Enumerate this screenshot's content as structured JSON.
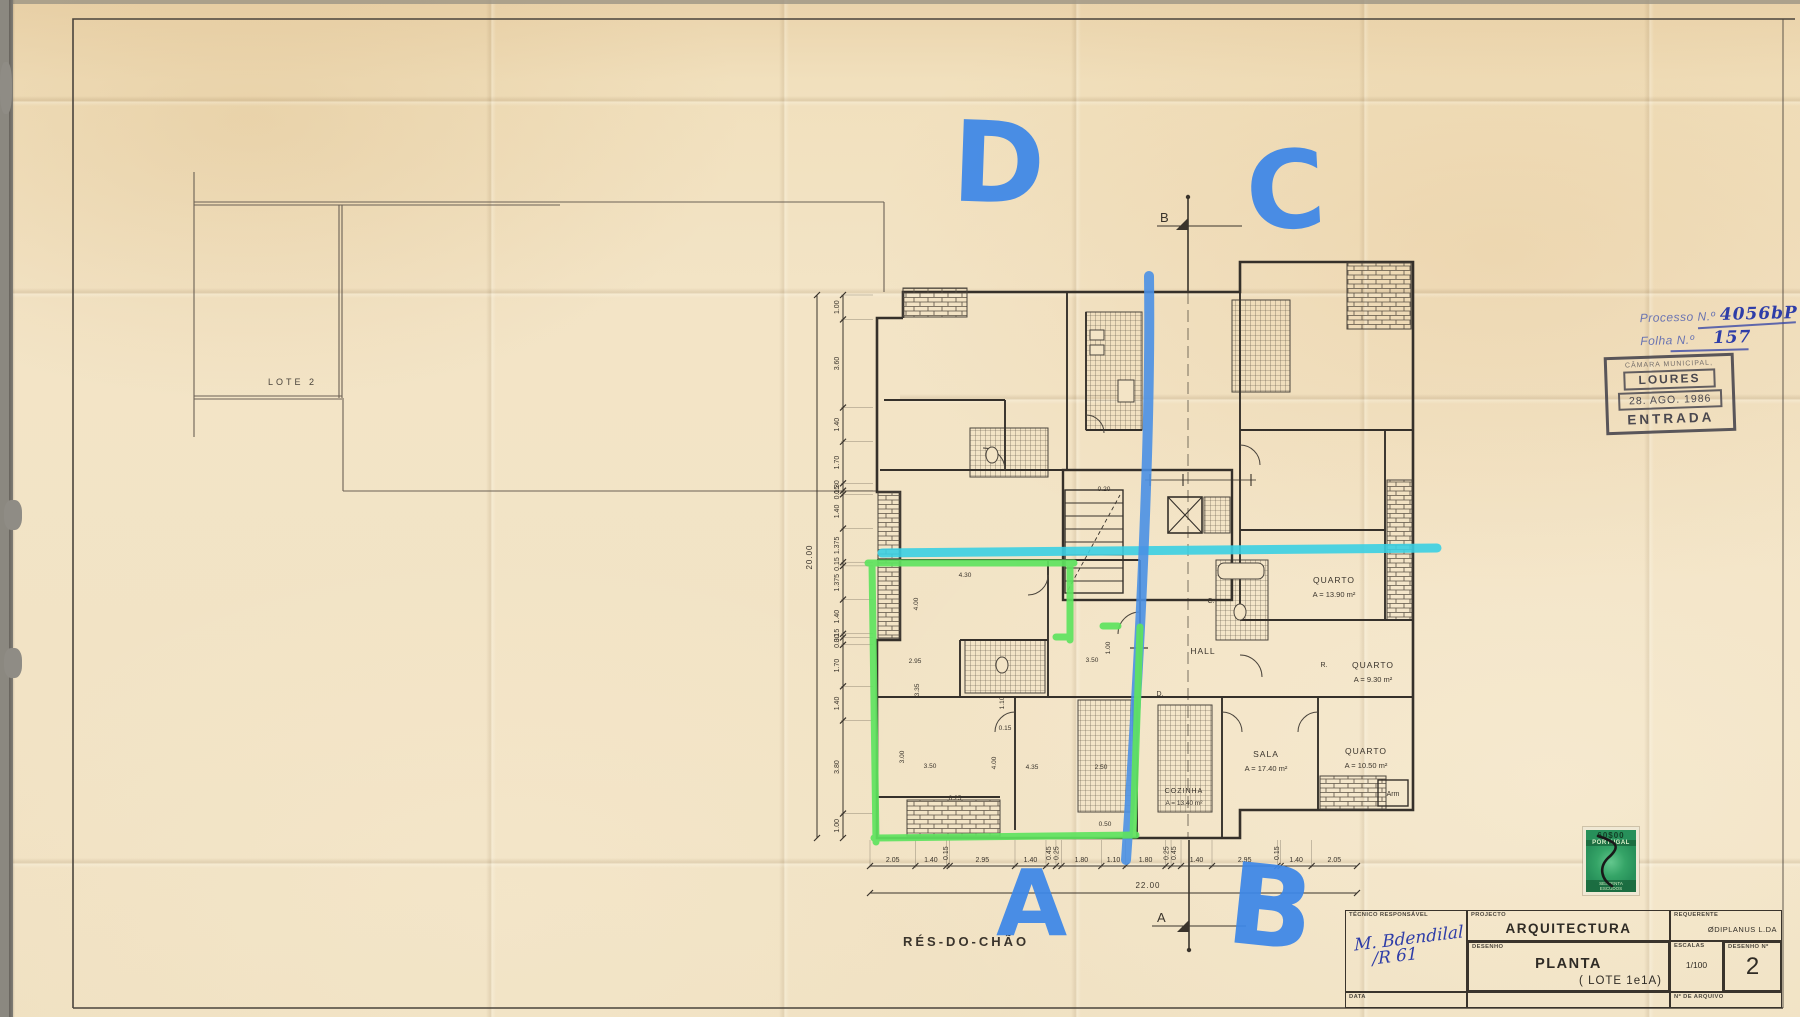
{
  "colors": {
    "marker_blue": "#3d87e8",
    "marker_cyan": "#3bcfe2",
    "marker_green": "#5fe35f",
    "ink": "#3a342c",
    "handwriting_navy": "#2e3da8",
    "stamp_grey": "#3e3d48",
    "revenue_green": "#2fa364",
    "paper": "#f3e4c6"
  },
  "overlay": {
    "letter_d": "D",
    "letter_c": "C",
    "letter_a": "A",
    "letter_b": "B"
  },
  "stamps": {
    "processo_label": "Processo N.º",
    "processo_value": "4056bP",
    "folha_label": "Folha N.º",
    "folha_value": "157",
    "municipal_line1": "CÂMARA MUNICIPAL,",
    "municipal_line2": "LOURES",
    "municipal_line3": "28. AGO. 1986",
    "municipal_line4": "ENTRADA",
    "revenue_value": "60$00",
    "revenue_country": "PORTUGAL",
    "revenue_denom1": "SESSENTA",
    "revenue_denom2": "ESCUDOS"
  },
  "plan": {
    "floor_label": "RÉS-DO-CHÃO",
    "site_label": "LOTE  2",
    "rooms": [
      {
        "name": "QUARTO",
        "area": "A = 13.90 m²"
      },
      {
        "name": "QUARTO",
        "area": "A = 9.30 m²"
      },
      {
        "name": "SALA",
        "area": "A = 17.40 m²"
      },
      {
        "name": "QUARTO",
        "area": "A = 10.50 m²"
      },
      {
        "name": "COZINHA",
        "area": "A = 13.40 m²"
      },
      {
        "name": "HALL",
        "area": ""
      },
      {
        "name": "Arm",
        "area": ""
      }
    ],
    "small_marks": {
      "c": "C.",
      "d": "D.",
      "r": "R."
    },
    "section_top": "B",
    "section_bottom": "A",
    "dims_bottom": [
      "2.05",
      "1.40",
      "0.15",
      "2.95",
      "1.40",
      "0.45",
      "0.25",
      "1.80",
      "1.10",
      "1.80",
      "0.25",
      "0.45",
      "1.40",
      "2.95",
      "0.15",
      "1.40",
      "2.05"
    ],
    "dims_bottom_total": "22.00",
    "dims_left": [
      "1.00",
      "3.60",
      "1.40",
      "1.70",
      "0.30",
      "0.15",
      "1.40",
      "1.375",
      "0.15",
      "1.375",
      "1.40",
      "0.15",
      "0.30",
      "1.70",
      "1.40",
      "3.80",
      "1.00"
    ],
    "dims_left_total": "20.00",
    "interior_dims": [
      "4.30",
      "4.00",
      "2.95",
      "3.35",
      "3.50",
      "3.00",
      "4.00",
      "4.35",
      "2.50",
      "1.10",
      "0.20",
      "0.15",
      "0.25",
      "0.50",
      "3.50",
      "1.00"
    ]
  },
  "titleblock": {
    "tecnico_label": "TÉCNICO RESPONSÁVEL",
    "signature1": "M. Bdendilal",
    "signature2": "/R 61",
    "projecto_label": "PROJECTO",
    "projecto_value": "ARQUITECTURA",
    "requerente_label": "REQUERENTE",
    "requerente_value": "ØDIPLANUS  L.DA",
    "desenho_label": "DESENHO",
    "desenho_value": "PLANTA",
    "desenho_value2": "( LOTE  1e1A)",
    "escalas_label": "ESCALAS",
    "escalas_value": "1/100",
    "num_label": "DESENHO Nº",
    "num_value": "2",
    "data_label": "DATA",
    "arquivo_label": "Nº DE ARQUIVO"
  }
}
